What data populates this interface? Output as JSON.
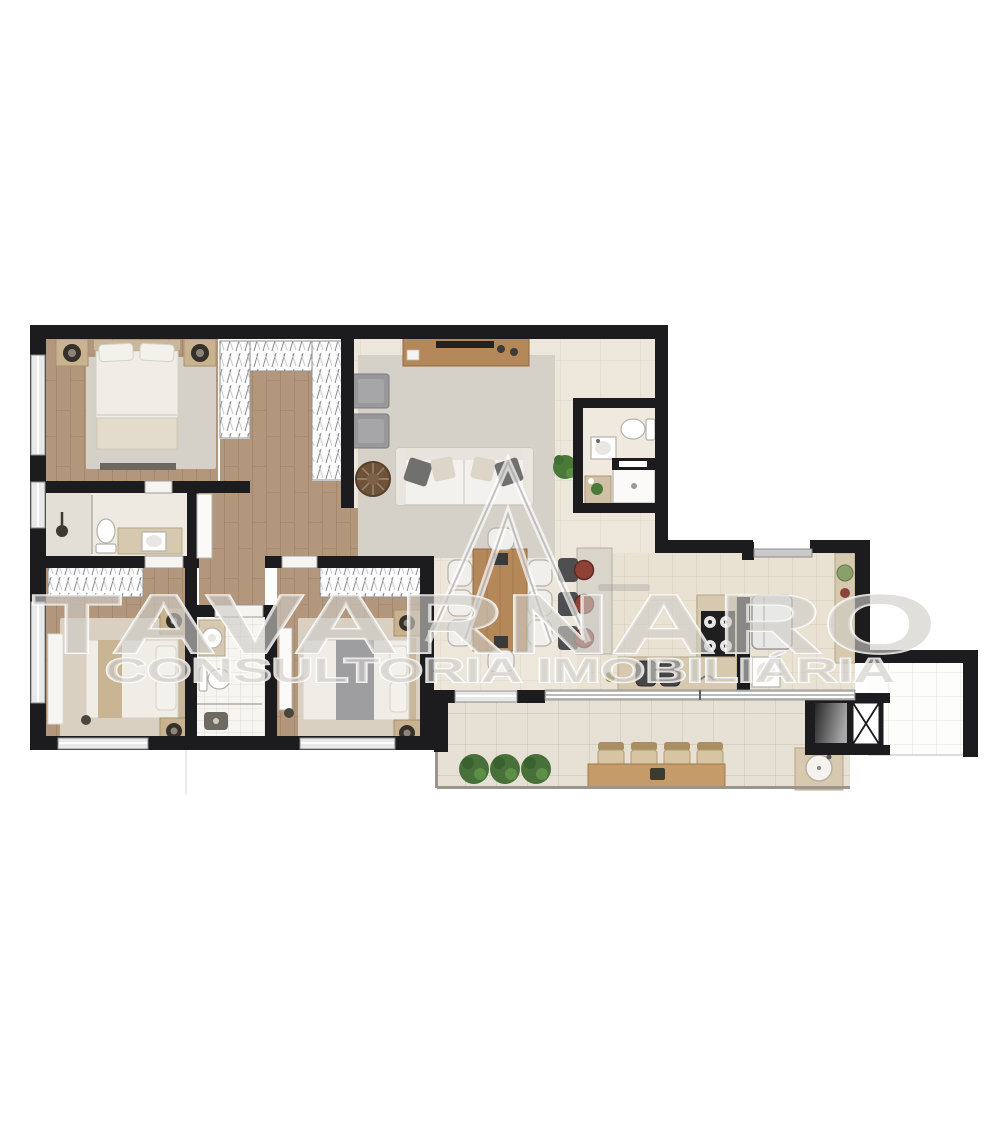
{
  "image_type": "real-estate apartment floor plan render",
  "watermark": {
    "brand": "TAVARNARO",
    "tagline": "CONSULTORIA IMOBILIÁRIA"
  },
  "palette": {
    "wall": "#1c1c1e",
    "wood_floor": "#b3977c",
    "living_tile": "#ece6db",
    "kitchen_tile": "#e9e1d1",
    "bath_tile": "#f6f4f0",
    "balcony_tile": "#e7e0d4",
    "terrace_tile": "#fdfdfc",
    "rug_large": "#d5d1c8",
    "rug_bedroom": "#d9d0c1",
    "counter_beige": "#d6c9af",
    "furniture_wood": "#b5885a",
    "sofa_white": "#f3f1ed",
    "armchair_gray": "#98979a",
    "stool_red": "#8f4136",
    "plant_green": "#4a7a39",
    "watermark_gray": "#c8c6c2"
  },
  "rooms": [
    {
      "name": "master-bedroom",
      "furniture": [
        "double-bed",
        "two-nightstands-with-lamps",
        "rug",
        "foot-bench"
      ]
    },
    {
      "name": "walk-in-closet",
      "furniture": [
        "u-shaped-wardrobe"
      ]
    },
    {
      "name": "master-bathroom",
      "furniture": [
        "shower",
        "toilet",
        "vanity-sink"
      ]
    },
    {
      "name": "bedroom-2",
      "furniture": [
        "double-bed",
        "wardrobe",
        "two-nightstands-with-lamps",
        "rug",
        "side-bench"
      ]
    },
    {
      "name": "bathroom-2",
      "furniture": [
        "vanity-sink",
        "toilet",
        "shower"
      ]
    },
    {
      "name": "bedroom-3",
      "furniture": [
        "double-bed",
        "wardrobe",
        "two-nightstands-with-lamps",
        "rug",
        "open-door"
      ]
    },
    {
      "name": "hallway",
      "furniture": [
        "open-door"
      ]
    },
    {
      "name": "living-room",
      "furniture": [
        "sofa",
        "two-armchairs",
        "round-coffee-table",
        "tv-sideboard",
        "rug",
        "plant"
      ]
    },
    {
      "name": "guest-toilet",
      "furniture": [
        "toilet",
        "sink",
        "shower",
        "cabinet-with-plant"
      ]
    },
    {
      "name": "dining-area",
      "furniture": [
        "table-with-eight-chairs"
      ]
    },
    {
      "name": "kitchen",
      "furniture": [
        "breakfast-bar-with-three-stools",
        "four-burner-cooktop",
        "refrigerator",
        "double-sink-counter",
        "side-counter-with-plant"
      ]
    },
    {
      "name": "service-area",
      "furniture": [
        "grill",
        "duct-shaft"
      ]
    },
    {
      "name": "gourmet-balcony",
      "furniture": [
        "wood-bar-counter",
        "four-stools",
        "three-planters",
        "round-sink"
      ]
    },
    {
      "name": "open-terrace",
      "furniture": []
    }
  ]
}
